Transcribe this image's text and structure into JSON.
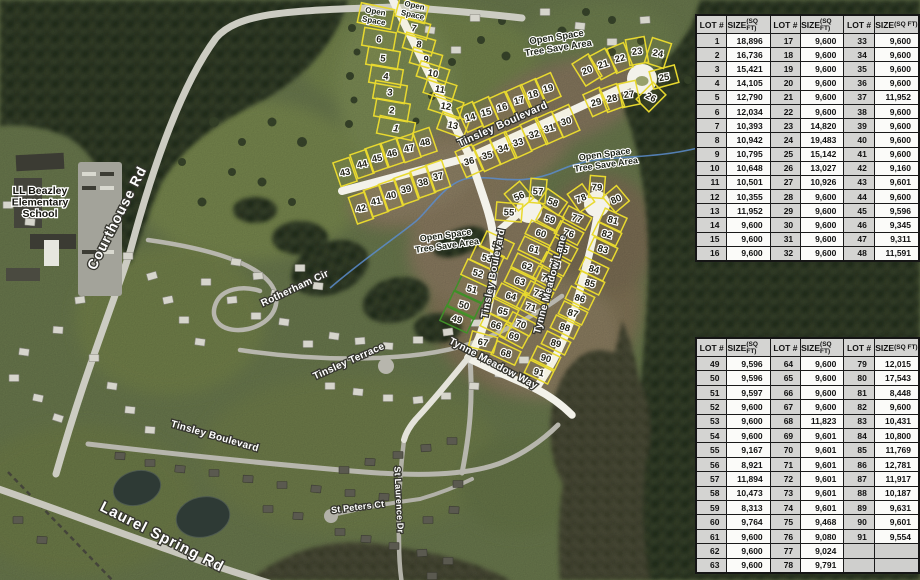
{
  "map": {
    "school_label": {
      "lines": [
        "LL Beazley",
        "Elementary",
        "School"
      ],
      "x": 40,
      "y": 194
    },
    "street_labels": [
      {
        "text": "Courthouse Rd",
        "x": 121,
        "y": 220,
        "rot": -63,
        "size": 14,
        "ls": 1
      },
      {
        "text": "Rotherham Cir",
        "x": 296,
        "y": 291,
        "rot": -25,
        "size": 10,
        "ls": 0.3
      },
      {
        "text": "Tinsley Terrace",
        "x": 350,
        "y": 364,
        "rot": -24,
        "size": 10,
        "ls": 0.3
      },
      {
        "text": "Tinsley  Boulevard",
        "x": 214,
        "y": 439,
        "rot": 16,
        "size": 10,
        "ls": 0.3
      },
      {
        "text": "Laurel Spring Rd",
        "x": 160,
        "y": 541,
        "rot": 27,
        "size": 15,
        "ls": 1
      },
      {
        "text": "St Peters Ct",
        "x": 358,
        "y": 510,
        "rot": -7,
        "size": 9,
        "ls": 0.2
      },
      {
        "text": "St Laurence Dr",
        "x": 396,
        "y": 500,
        "rot": 87,
        "size": 9,
        "ls": 0.2
      },
      {
        "text": "Tinsley  Boulevard",
        "x": 504,
        "y": 127,
        "rot": -24,
        "size": 10.5,
        "ls": 0.4
      },
      {
        "text": "Tinsley  Boulevard",
        "x": 496,
        "y": 274,
        "rot": -79,
        "size": 10,
        "ls": 0.3
      },
      {
        "text": "Tynne Meadow Lane",
        "x": 553,
        "y": 285,
        "rot": -75,
        "size": 10,
        "ls": 0.3
      },
      {
        "text": "Tynne Meadow Way",
        "x": 492,
        "y": 366,
        "rot": 28,
        "size": 10,
        "ls": 0.3
      }
    ],
    "area_labels": [
      {
        "lines": [
          "Open",
          "Space"
        ],
        "x": 375,
        "y": 14,
        "rot": 10,
        "size": 8
      },
      {
        "lines": [
          "Open",
          "Space"
        ],
        "x": 414,
        "y": 8,
        "rot": 12,
        "size": 8
      },
      {
        "lines": [
          "Open Space",
          "Tree Save Area"
        ],
        "x": 557,
        "y": 40,
        "rot": -9,
        "size": 9.5
      },
      {
        "lines": [
          "Open Space",
          "Tree Save Area"
        ],
        "x": 605,
        "y": 157,
        "rot": -8,
        "size": 9
      },
      {
        "lines": [
          "Open Space",
          "Tree Save Area"
        ],
        "x": 446,
        "y": 238,
        "rot": -8,
        "size": 9
      }
    ],
    "lots": [
      {
        "n": "",
        "x": 376,
        "y": 16,
        "a": 12,
        "w": 34,
        "h": 20
      },
      {
        "n": "",
        "x": 412,
        "y": 11,
        "a": 15,
        "w": 30,
        "h": 18
      },
      {
        "n": "6",
        "x": 379,
        "y": 39,
        "a": 10,
        "w": 32,
        "h": 18
      },
      {
        "n": "5",
        "x": 383,
        "y": 58,
        "a": 10,
        "w": 32,
        "h": 18
      },
      {
        "n": "4",
        "x": 386,
        "y": 76,
        "a": 10,
        "w": 32,
        "h": 18
      },
      {
        "n": "3",
        "x": 390,
        "y": 92,
        "a": 10,
        "w": 32,
        "h": 18
      },
      {
        "n": "2",
        "x": 392,
        "y": 110,
        "a": 10,
        "w": 34,
        "h": 18
      },
      {
        "n": "1",
        "x": 396,
        "y": 128,
        "a": 12,
        "w": 36,
        "h": 18
      },
      {
        "n": "7",
        "x": 414,
        "y": 28,
        "a": 16,
        "w": 30,
        "h": 16
      },
      {
        "n": "8",
        "x": 419,
        "y": 44,
        "a": 16,
        "w": 30,
        "h": 16
      },
      {
        "n": "9",
        "x": 426,
        "y": 59,
        "a": 16,
        "w": 30,
        "h": 16
      },
      {
        "n": "10",
        "x": 433,
        "y": 73,
        "a": 18,
        "w": 30,
        "h": 16
      },
      {
        "n": "11",
        "x": 440,
        "y": 89,
        "a": 18,
        "w": 30,
        "h": 17
      },
      {
        "n": "12",
        "x": 446,
        "y": 106,
        "a": 18,
        "w": 32,
        "h": 17
      },
      {
        "n": "13",
        "x": 453,
        "y": 125,
        "a": 20,
        "w": 28,
        "h": 18
      },
      {
        "n": "14",
        "x": 470,
        "y": 117,
        "a": -24,
        "w": 17,
        "h": 26
      },
      {
        "n": "15",
        "x": 486,
        "y": 112,
        "a": -24,
        "w": 17,
        "h": 26
      },
      {
        "n": "16",
        "x": 502,
        "y": 107,
        "a": -24,
        "w": 17,
        "h": 26
      },
      {
        "n": "17",
        "x": 519,
        "y": 100,
        "a": -24,
        "w": 17,
        "h": 26
      },
      {
        "n": "18",
        "x": 533,
        "y": 94,
        "a": -24,
        "w": 17,
        "h": 26
      },
      {
        "n": "19",
        "x": 548,
        "y": 88,
        "a": -24,
        "w": 17,
        "h": 26
      },
      {
        "n": "20",
        "x": 587,
        "y": 70,
        "a": -32,
        "w": 19,
        "h": 26
      },
      {
        "n": "21",
        "x": 603,
        "y": 64,
        "a": -28,
        "w": 18,
        "h": 26
      },
      {
        "n": "22",
        "x": 620,
        "y": 58,
        "a": -22,
        "w": 18,
        "h": 26
      },
      {
        "n": "23",
        "x": 637,
        "y": 51,
        "a": -10,
        "w": 19,
        "h": 26
      },
      {
        "n": "24",
        "x": 658,
        "y": 53,
        "a": 18,
        "w": 20,
        "h": 26
      },
      {
        "n": "25",
        "x": 664,
        "y": 77,
        "a": 75,
        "w": 18,
        "h": 26
      },
      {
        "n": "26",
        "x": 651,
        "y": 97,
        "a": 45,
        "w": 18,
        "h": 24
      },
      {
        "n": "27",
        "x": 629,
        "y": 94,
        "a": -12,
        "w": 18,
        "h": 24
      },
      {
        "n": "28",
        "x": 612,
        "y": 98,
        "a": -20,
        "w": 18,
        "h": 24
      },
      {
        "n": "29",
        "x": 596,
        "y": 102,
        "a": -24,
        "w": 18,
        "h": 24
      },
      {
        "n": "30",
        "x": 566,
        "y": 121,
        "a": -24,
        "w": 18,
        "h": 28
      },
      {
        "n": "31",
        "x": 549,
        "y": 128,
        "a": -24,
        "w": 18,
        "h": 28
      },
      {
        "n": "32",
        "x": 534,
        "y": 134,
        "a": -24,
        "w": 18,
        "h": 28
      },
      {
        "n": "33",
        "x": 518,
        "y": 142,
        "a": -24,
        "w": 18,
        "h": 28
      },
      {
        "n": "34",
        "x": 503,
        "y": 148,
        "a": -24,
        "w": 18,
        "h": 28
      },
      {
        "n": "35",
        "x": 487,
        "y": 155,
        "a": -24,
        "w": 18,
        "h": 28
      },
      {
        "n": "36",
        "x": 469,
        "y": 161,
        "a": -24,
        "w": 18,
        "h": 28
      },
      {
        "n": "37",
        "x": 438,
        "y": 176,
        "a": -19,
        "w": 17,
        "h": 28
      },
      {
        "n": "38",
        "x": 423,
        "y": 182,
        "a": -19,
        "w": 17,
        "h": 28
      },
      {
        "n": "39",
        "x": 406,
        "y": 189,
        "a": -19,
        "w": 17,
        "h": 28
      },
      {
        "n": "40",
        "x": 391,
        "y": 195,
        "a": -19,
        "w": 17,
        "h": 28
      },
      {
        "n": "41",
        "x": 376,
        "y": 201,
        "a": -19,
        "w": 17,
        "h": 28
      },
      {
        "n": "42",
        "x": 361,
        "y": 208,
        "a": -19,
        "w": 17,
        "h": 28
      },
      {
        "n": "43",
        "x": 345,
        "y": 172,
        "a": -19,
        "w": 17,
        "h": 25
      },
      {
        "n": "44",
        "x": 362,
        "y": 164,
        "a": -19,
        "w": 17,
        "h": 25
      },
      {
        "n": "45",
        "x": 377,
        "y": 158,
        "a": -19,
        "w": 17,
        "h": 25
      },
      {
        "n": "46",
        "x": 392,
        "y": 153,
        "a": -19,
        "w": 17,
        "h": 25
      },
      {
        "n": "47",
        "x": 409,
        "y": 148,
        "a": -19,
        "w": 17,
        "h": 25
      },
      {
        "n": "48",
        "x": 425,
        "y": 142,
        "a": -19,
        "w": 17,
        "h": 25
      },
      {
        "n": "49",
        "x": 457,
        "y": 319,
        "a": 25,
        "w": 30,
        "h": 17,
        "g": true
      },
      {
        "n": "50",
        "x": 464,
        "y": 305,
        "a": 25,
        "w": 30,
        "h": 17,
        "g": true
      },
      {
        "n": "51",
        "x": 472,
        "y": 289,
        "a": 25,
        "w": 30,
        "h": 17,
        "g": true
      },
      {
        "n": "52",
        "x": 478,
        "y": 273,
        "a": 25,
        "w": 30,
        "h": 17
      },
      {
        "n": "53",
        "x": 487,
        "y": 258,
        "a": 25,
        "w": 30,
        "h": 17
      },
      {
        "n": "54",
        "x": 497,
        "y": 245,
        "a": 25,
        "w": 30,
        "h": 17
      },
      {
        "n": "55",
        "x": 509,
        "y": 212,
        "a": 5,
        "w": 26,
        "h": 18
      },
      {
        "n": "56",
        "x": 519,
        "y": 196,
        "a": -40,
        "w": 20,
        "h": 22
      },
      {
        "n": "57",
        "x": 538,
        "y": 191,
        "a": -85,
        "w": 24,
        "h": 16
      },
      {
        "n": "58",
        "x": 553,
        "y": 202,
        "a": 35,
        "w": 24,
        "h": 16
      },
      {
        "n": "59",
        "x": 550,
        "y": 219,
        "a": 28,
        "w": 24,
        "h": 15
      },
      {
        "n": "60",
        "x": 541,
        "y": 233,
        "a": 26,
        "w": 28,
        "h": 15
      },
      {
        "n": "61",
        "x": 534,
        "y": 249,
        "a": 26,
        "w": 28,
        "h": 15
      },
      {
        "n": "62",
        "x": 527,
        "y": 266,
        "a": 26,
        "w": 28,
        "h": 15
      },
      {
        "n": "63",
        "x": 520,
        "y": 281,
        "a": 26,
        "w": 28,
        "h": 15
      },
      {
        "n": "64",
        "x": 511,
        "y": 296,
        "a": 26,
        "w": 28,
        "h": 15
      },
      {
        "n": "65",
        "x": 503,
        "y": 311,
        "a": 26,
        "w": 28,
        "h": 15
      },
      {
        "n": "66",
        "x": 496,
        "y": 325,
        "a": 26,
        "w": 28,
        "h": 15
      },
      {
        "n": "67",
        "x": 483,
        "y": 342,
        "a": 15,
        "w": 26,
        "h": 16
      },
      {
        "n": "68",
        "x": 506,
        "y": 353,
        "a": 25,
        "w": 26,
        "h": 15
      },
      {
        "n": "69",
        "x": 514,
        "y": 336,
        "a": 28,
        "w": 26,
        "h": 14
      },
      {
        "n": "70",
        "x": 521,
        "y": 324,
        "a": 28,
        "w": 26,
        "h": 14
      },
      {
        "n": "71",
        "x": 531,
        "y": 307,
        "a": 28,
        "w": 26,
        "h": 14
      },
      {
        "n": "72",
        "x": 539,
        "y": 293,
        "a": 28,
        "w": 26,
        "h": 14
      },
      {
        "n": "73",
        "x": 547,
        "y": 278,
        "a": 28,
        "w": 26,
        "h": 14
      },
      {
        "n": "74",
        "x": 555,
        "y": 264,
        "a": 28,
        "w": 26,
        "h": 14
      },
      {
        "n": "75",
        "x": 563,
        "y": 249,
        "a": 28,
        "w": 26,
        "h": 14
      },
      {
        "n": "76",
        "x": 569,
        "y": 233,
        "a": 28,
        "w": 26,
        "h": 14
      },
      {
        "n": "77",
        "x": 577,
        "y": 218,
        "a": 28,
        "w": 26,
        "h": 14
      },
      {
        "n": "78",
        "x": 581,
        "y": 198,
        "a": -35,
        "w": 18,
        "h": 22
      },
      {
        "n": "79",
        "x": 597,
        "y": 187,
        "a": -85,
        "w": 22,
        "h": 15
      },
      {
        "n": "80",
        "x": 616,
        "y": 199,
        "a": 50,
        "w": 20,
        "h": 18
      },
      {
        "n": "81",
        "x": 613,
        "y": 220,
        "a": 25,
        "w": 24,
        "h": 15
      },
      {
        "n": "82",
        "x": 607,
        "y": 234,
        "a": 26,
        "w": 26,
        "h": 14
      },
      {
        "n": "83",
        "x": 603,
        "y": 249,
        "a": 26,
        "w": 26,
        "h": 14
      },
      {
        "n": "84",
        "x": 594,
        "y": 269,
        "a": 26,
        "w": 26,
        "h": 14
      },
      {
        "n": "85",
        "x": 590,
        "y": 283,
        "a": 26,
        "w": 26,
        "h": 14
      },
      {
        "n": "86",
        "x": 580,
        "y": 298,
        "a": 26,
        "w": 26,
        "h": 14
      },
      {
        "n": "87",
        "x": 573,
        "y": 313,
        "a": 26,
        "w": 26,
        "h": 14
      },
      {
        "n": "88",
        "x": 565,
        "y": 327,
        "a": 26,
        "w": 26,
        "h": 14
      },
      {
        "n": "89",
        "x": 556,
        "y": 343,
        "a": 26,
        "w": 26,
        "h": 14
      },
      {
        "n": "90",
        "x": 546,
        "y": 358,
        "a": 26,
        "w": 26,
        "h": 14
      },
      {
        "n": "91",
        "x": 539,
        "y": 372,
        "a": 26,
        "w": 26,
        "h": 14
      }
    ],
    "colors": {
      "lot_line": "#e8d92f",
      "lot_line_green": "#3f8f28",
      "road_new": "#f3f2ea",
      "stream": "#5b8ccc"
    }
  },
  "tables": {
    "col_headers": {
      "lot": "LOT #",
      "size": "SIZE",
      "size_sub": "(SQ FT)"
    },
    "table1": {
      "rows": [
        [
          "1",
          "18,896",
          "17",
          "9,600",
          "33",
          "9,600"
        ],
        [
          "2",
          "16,736",
          "18",
          "9,600",
          "34",
          "9,600"
        ],
        [
          "3",
          "15,421",
          "19",
          "9,600",
          "35",
          "9,600"
        ],
        [
          "4",
          "14,105",
          "20",
          "9,600",
          "36",
          "9,600"
        ],
        [
          "5",
          "12,790",
          "21",
          "9,600",
          "37",
          "11,952"
        ],
        [
          "6",
          "12,034",
          "22",
          "9,600",
          "38",
          "9,600"
        ],
        [
          "7",
          "10,393",
          "23",
          "14,820",
          "39",
          "9,600"
        ],
        [
          "8",
          "10,942",
          "24",
          "19,483",
          "40",
          "9,600"
        ],
        [
          "9",
          "10,795",
          "25",
          "15,142",
          "41",
          "9,600"
        ],
        [
          "10",
          "10,648",
          "26",
          "13,027",
          "42",
          "9,160"
        ],
        [
          "11",
          "10,501",
          "27",
          "10,926",
          "43",
          "9,601"
        ],
        [
          "12",
          "10,355",
          "28",
          "9,600",
          "44",
          "9,600"
        ],
        [
          "13",
          "11,952",
          "29",
          "9,600",
          "45",
          "9,596"
        ],
        [
          "14",
          "9,600",
          "30",
          "9,600",
          "46",
          "9,345"
        ],
        [
          "15",
          "9,600",
          "31",
          "9,600",
          "47",
          "9,311"
        ],
        [
          "16",
          "9,600",
          "32",
          "9,600",
          "48",
          "11,591"
        ]
      ]
    },
    "table2": {
      "rows": [
        [
          "49",
          "9,596",
          "64",
          "9,600",
          "79",
          "12,015"
        ],
        [
          "50",
          "9,596",
          "65",
          "9,600",
          "80",
          "17,543"
        ],
        [
          "51",
          "9,597",
          "66",
          "9,600",
          "81",
          "8,448"
        ],
        [
          "52",
          "9,600",
          "67",
          "9,600",
          "82",
          "9,600"
        ],
        [
          "53",
          "9,600",
          "68",
          "11,823",
          "83",
          "10,431"
        ],
        [
          "54",
          "9,600",
          "69",
          "9,601",
          "84",
          "10,800"
        ],
        [
          "55",
          "9,167",
          "70",
          "9,601",
          "85",
          "11,769"
        ],
        [
          "56",
          "8,921",
          "71",
          "9,601",
          "86",
          "12,781"
        ],
        [
          "57",
          "11,894",
          "72",
          "9,601",
          "87",
          "11,917"
        ],
        [
          "58",
          "10,473",
          "73",
          "9,601",
          "88",
          "10,187"
        ],
        [
          "59",
          "8,313",
          "74",
          "9,601",
          "89",
          "9,631"
        ],
        [
          "60",
          "9,764",
          "75",
          "9,468",
          "90",
          "9,601"
        ],
        [
          "61",
          "9,600",
          "76",
          "9,080",
          "91",
          "9,554"
        ],
        [
          "62",
          "9,600",
          "77",
          "9,024",
          "",
          ""
        ],
        [
          "63",
          "9,600",
          "78",
          "9,791",
          "",
          ""
        ]
      ]
    }
  }
}
